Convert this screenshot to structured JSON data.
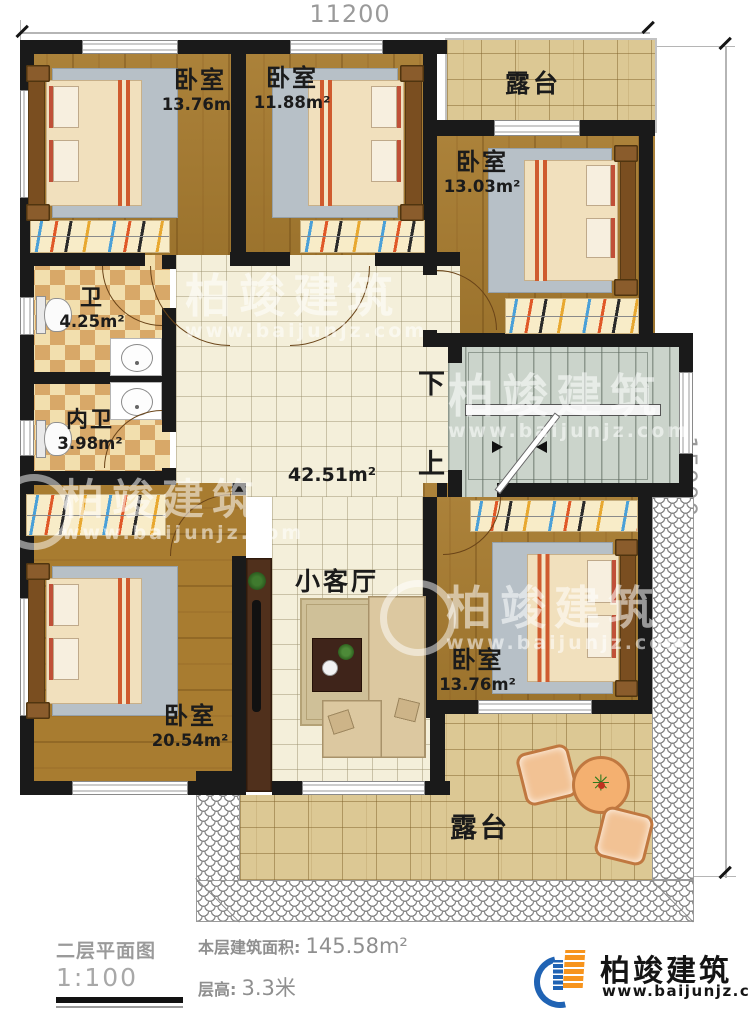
{
  "dimensions": {
    "top_width": "11200",
    "right_height": "15000"
  },
  "rooms": {
    "bedroom_top_left": {
      "name": "卧室",
      "area": "13.76m²"
    },
    "bedroom_top_mid": {
      "name": "卧室",
      "area": "11.88m²"
    },
    "bedroom_top_right": {
      "name": "卧室",
      "area": "13.03m²"
    },
    "bathroom": {
      "name": "卫",
      "area": "4.25m²"
    },
    "ensuite_bathroom": {
      "name": "内卫",
      "area": "3.98m²"
    },
    "hall": {
      "area": "42.51m²"
    },
    "living_room": {
      "name": "小客厅"
    },
    "bedroom_bottom_left": {
      "name": "卧室",
      "area": "20.54m²"
    },
    "bedroom_bottom_right": {
      "name": "卧室",
      "area": "13.76m²"
    },
    "terrace_top": {
      "name": "露台"
    },
    "terrace_bottom": {
      "name": "露台"
    }
  },
  "stairs": {
    "down_label": "下",
    "up_label": "上"
  },
  "watermark": {
    "text": "柏竣建筑",
    "url": "www.baijunjz.com"
  },
  "footer": {
    "plan_label": "二层平面图",
    "plan_scale": "1:100",
    "area_label": "本层建筑面积:",
    "area_value": "145.58m²",
    "floor_height_label": "层高:",
    "floor_height_value": "3.3米"
  },
  "brand": {
    "name": "柏竣建筑",
    "url": "www.baijunjz.com"
  },
  "colors": {
    "wall": "#1a1a1a",
    "wood": "#a87c30",
    "tile": "#f4efda",
    "stair": "#cbd4cb",
    "paver": "#dcc894",
    "brand_blue": "#2063b4",
    "brand_orange": "#f7941d"
  }
}
